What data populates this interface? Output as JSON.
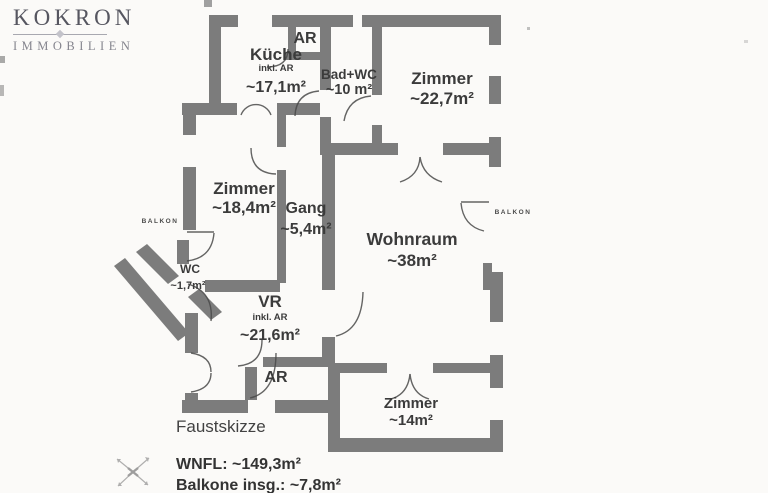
{
  "brand": {
    "name": "KOKRON",
    "division": "IMMOBILIEN"
  },
  "floorplan": {
    "caption": "Faustskizze",
    "rooms": [
      {
        "name": "Küche",
        "note": "inkl. AR",
        "area": "~17,1m²"
      },
      {
        "name": "AR"
      },
      {
        "name": "Bad+WC",
        "area": "~10 m²"
      },
      {
        "name": "Zimmer",
        "area": "~22,7m²"
      },
      {
        "name": "Zimmer",
        "area": "~18,4m²"
      },
      {
        "name": "Gang",
        "area": "~5,4m²"
      },
      {
        "name": "Wohnraum",
        "area": "~38m²"
      },
      {
        "name": "WC",
        "area": "~1,7m²"
      },
      {
        "name": "VR",
        "note": "inkl. AR",
        "area": "~21,6m²"
      },
      {
        "name": "AR"
      },
      {
        "name": "Zimmer",
        "area": "~14m²"
      }
    ],
    "balconies": [
      {
        "name": "BALKON"
      },
      {
        "name": "BALKON"
      }
    ],
    "totals": {
      "wnfl_label": "WNFL:",
      "wnfl_value": "~149,3m²",
      "balcony_label": "Balkone insg.:",
      "balcony_value": "~7,8m²"
    }
  },
  "colors": {
    "wall": "#7c7c7c",
    "label": "#3b3b3b",
    "paper": "#fbfaf8",
    "logo_primary": "#565660",
    "logo_secondary": "#85858e"
  }
}
